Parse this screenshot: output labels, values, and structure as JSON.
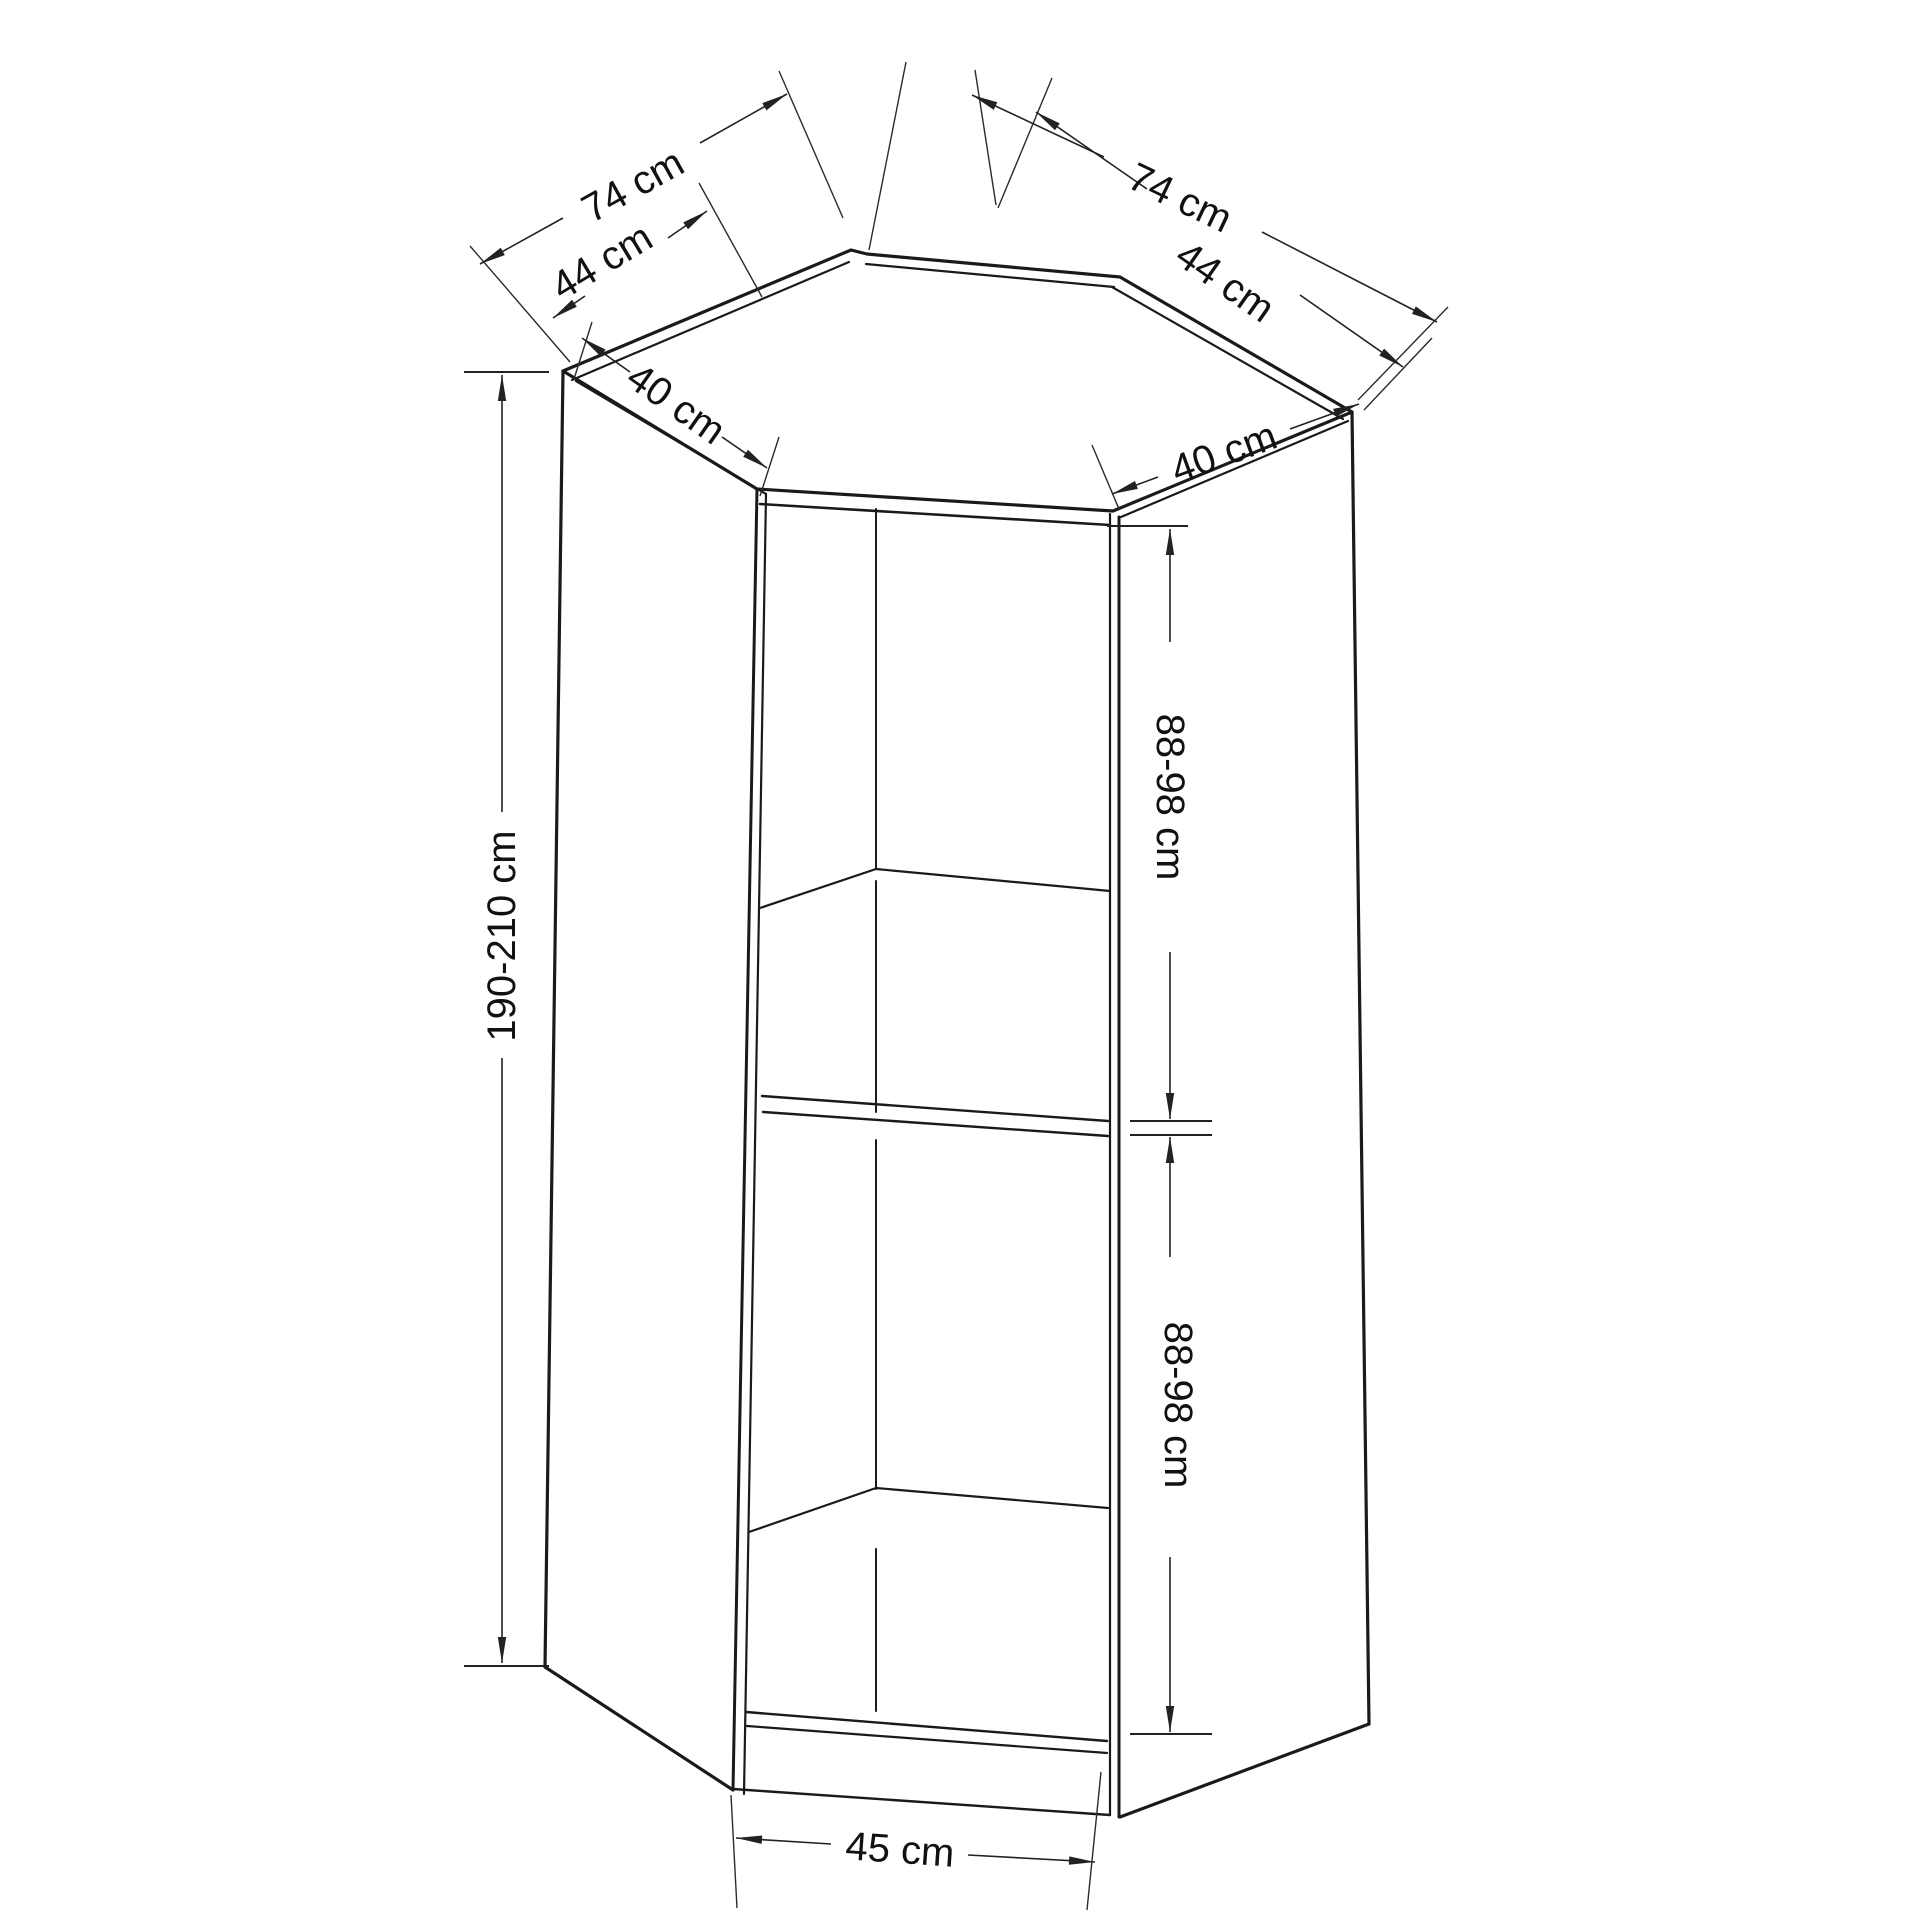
{
  "diagram": {
    "type": "furniture-dimension-drawing",
    "subject": "corner wardrobe / corner cabinet shown as isometric outline with open front, two interior shelves, middle divider and base plinth",
    "colors": {
      "background": "#ffffff",
      "object_line": "#1a1a1a",
      "dimension_line": "#222222",
      "label_text": "#111111"
    },
    "dimensions": {
      "top_left_outer": "74 cm",
      "top_left_inner": "44 cm",
      "side_left_depth": "40 cm",
      "top_right_outer": "74 cm",
      "top_right_inner": "44 cm",
      "side_right_depth": "40 cm",
      "height_total": "190-210 cm",
      "section_upper": "88-98 cm",
      "section_lower": "88-98 cm",
      "opening_width": "45 cm"
    }
  }
}
